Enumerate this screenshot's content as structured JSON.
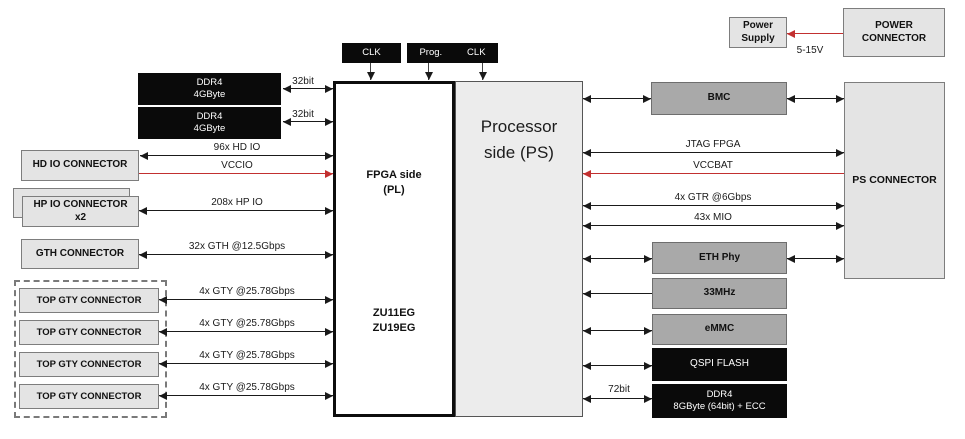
{
  "clocks": {
    "clk1": "CLK",
    "prog": "Prog.",
    "clk2": "CLK"
  },
  "power": {
    "supply": [
      "Power",
      "Supply"
    ],
    "connector": [
      "POWER",
      "CONNECTOR"
    ],
    "voltage": "5-15V"
  },
  "fpga": {
    "title": [
      "FPGA side",
      "(PL)"
    ],
    "chips": [
      "ZU11EG",
      "ZU19EG"
    ]
  },
  "ps": {
    "title": [
      "Processor",
      "side (PS)"
    ]
  },
  "left": {
    "ddr4_top": [
      "DDR4",
      "4GByte"
    ],
    "ddr4_bottom": [
      "DDR4",
      "4GByte"
    ],
    "hd_io": "HD IO CONNECTOR",
    "hp_io": [
      "HP IO CONNECTOR",
      "x2"
    ],
    "gth": "GTH CONNECTOR",
    "gty": [
      "TOP GTY CONNECTOR",
      "TOP GTY CONNECTOR",
      "TOP GTY CONNECTOR",
      "TOP GTY CONNECTOR"
    ]
  },
  "right": {
    "bmc": "BMC",
    "ps_connector": "PS CONNECTOR",
    "eth_phy": "ETH Phy",
    "osc": "33MHz",
    "emmc": "eMMC",
    "qspi": "QSPI FLASH",
    "ddr4": [
      "DDR4",
      "8GByte (64bit) + ECC"
    ]
  },
  "buses": {
    "ddr_top": "32bit",
    "ddr_bottom": "32bit",
    "hd_io": "96x HD IO",
    "vccio": "VCCIO",
    "hp_io": "208x HP IO",
    "gth": "32x GTH @12.5Gbps",
    "gty": [
      "4x GTY @25.78Gbps",
      "4x GTY @25.78Gbps",
      "4x GTY @25.78Gbps",
      "4x GTY @25.78Gbps"
    ],
    "jtag": "JTAG FPGA",
    "vccbat": "VCCBAT",
    "gtr": "4x GTR @6Gbps",
    "mio": "43x MIO",
    "ps_ddr": "72bit"
  },
  "colors": {
    "accent_red": "#c23030",
    "black_box": "#0a0a0a",
    "mid_gray": "#a9a9a9",
    "light_gray": "#e4e4e4",
    "ps_fill": "#ececec"
  }
}
